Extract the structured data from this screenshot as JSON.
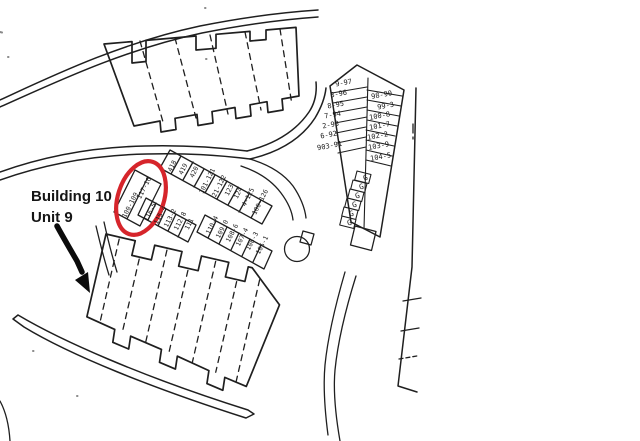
{
  "annotation": {
    "building_label": "Building 10",
    "unit_label": "Unit 9"
  },
  "map": {
    "circled_spaces": [
      "117-16",
      "100-109"
    ],
    "row_upper": [
      "418",
      "419",
      "420",
      "101-121",
      "21-122",
      "123",
      "124",
      "4-125",
      "100-126"
    ],
    "row_lower": [
      "116-5",
      "115-4",
      "113-2",
      "112-8",
      "111",
      "110-4",
      "109-0",
      "108-6",
      "107-4",
      "106-3",
      "105-1"
    ],
    "right_block_left": [
      "9-97",
      "3-96",
      "8-95",
      "7-94",
      "2-93",
      "6-92",
      "903-91"
    ],
    "right_block_right": [
      "98-90",
      "99-3",
      "100-8",
      "101-7",
      "102-2",
      "103-9",
      "104-5"
    ],
    "garage_spaces": [
      "G",
      "G",
      "G",
      "G",
      "G",
      "G"
    ]
  },
  "colors": {
    "ink": "#1f1f1f",
    "highlight_red": "#d6252b",
    "arrow_black": "#0b0b0b"
  }
}
